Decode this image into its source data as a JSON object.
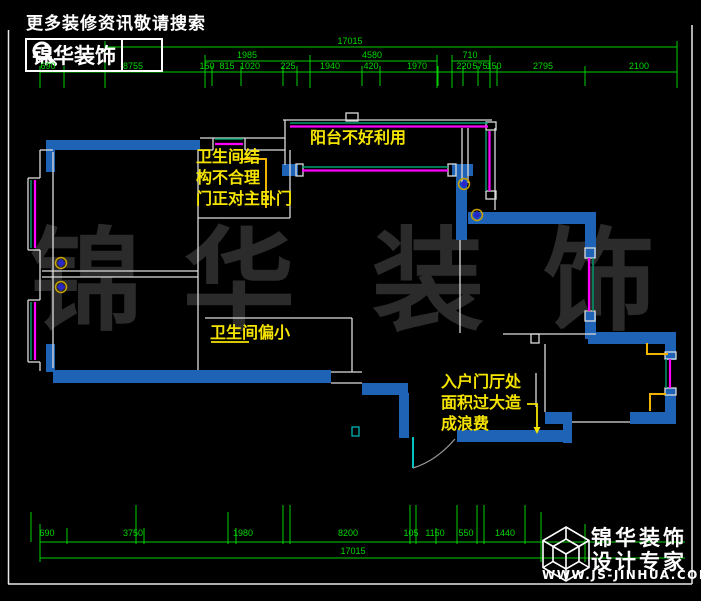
{
  "header": {
    "slogan": "更多装修资讯敬请搜索",
    "logo_text": "锦华装饰",
    "search_icon": "magnifier-icon"
  },
  "watermark": {
    "chars": [
      "锦",
      "华",
      "装",
      "饰"
    ]
  },
  "annotations": [
    {
      "id": "bathroom-structure",
      "x": 196,
      "y": 146,
      "lines": [
        "卫生间结",
        "构不合理",
        "门正对主卧门"
      ]
    },
    {
      "id": "balcony",
      "x": 310,
      "y": 127,
      "lines": [
        "阳台不好利用"
      ]
    },
    {
      "id": "bathroom-small",
      "x": 210,
      "y": 322,
      "lines": [
        "卫生间偏小"
      ]
    },
    {
      "id": "foyer-waste",
      "x": 441,
      "y": 371,
      "lines": [
        "入户门厅处",
        "面积过大造",
        "成浪费"
      ]
    }
  ],
  "dimensions": {
    "top": [
      {
        "v": "17015",
        "x": 350,
        "y": 36
      },
      {
        "v": "1985",
        "x": 247,
        "y": 50
      },
      {
        "v": "4580",
        "x": 372,
        "y": 50
      },
      {
        "v": "710",
        "x": 470,
        "y": 50
      },
      {
        "v": "690",
        "x": 48,
        "y": 61
      },
      {
        "v": "8755",
        "x": 133,
        "y": 61
      },
      {
        "v": "150",
        "x": 207,
        "y": 61
      },
      {
        "v": "815",
        "x": 227,
        "y": 61
      },
      {
        "v": "1020",
        "x": 250,
        "y": 61
      },
      {
        "v": "225",
        "x": 288,
        "y": 61
      },
      {
        "v": "1940",
        "x": 330,
        "y": 61
      },
      {
        "v": "420",
        "x": 371,
        "y": 61
      },
      {
        "v": "1970",
        "x": 417,
        "y": 61
      },
      {
        "v": "220",
        "x": 464,
        "y": 61
      },
      {
        "v": "575",
        "x": 480,
        "y": 61
      },
      {
        "v": "150",
        "x": 494,
        "y": 61
      },
      {
        "v": "2795",
        "x": 543,
        "y": 61
      },
      {
        "v": "2100",
        "x": 639,
        "y": 61
      }
    ],
    "bottom": [
      {
        "v": "690",
        "x": 47,
        "y": 528
      },
      {
        "v": "3750",
        "x": 133,
        "y": 528
      },
      {
        "v": "1980",
        "x": 243,
        "y": 528
      },
      {
        "v": "8200",
        "x": 348,
        "y": 528
      },
      {
        "v": "105",
        "x": 411,
        "y": 528
      },
      {
        "v": "1150",
        "x": 435,
        "y": 528
      },
      {
        "v": "550",
        "x": 466,
        "y": 528
      },
      {
        "v": "1440",
        "x": 505,
        "y": 528
      },
      {
        "v": "17015",
        "x": 353,
        "y": 546
      }
    ]
  },
  "brand": {
    "name_line1": "锦华装饰",
    "name_line2": "设计专家",
    "website": "WWW.JS-JINHUA.COM",
    "cube_icon": "cube-logo-icon"
  },
  "colors": {
    "dimension_green": "#00cf00",
    "wall_blue": "#1e63b5",
    "window_magenta": "#ff00ff",
    "window_teal": "#00a070",
    "annotation_yellow": "#f5e400",
    "door_frame_yellow": "#f0b400",
    "entry_door_cyan": "#00c2c2",
    "watermark_gray": "#2b2b2b"
  }
}
